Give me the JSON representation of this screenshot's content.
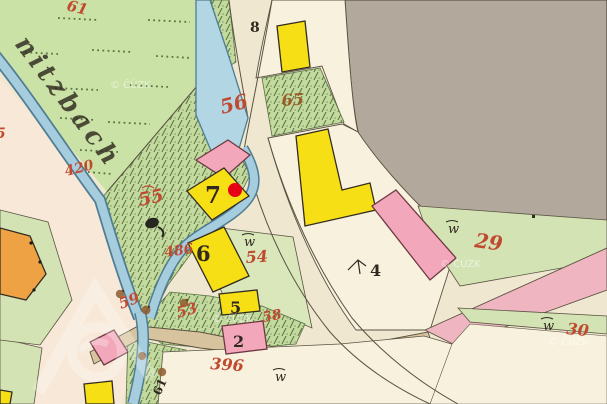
{
  "map": {
    "description": "Historical cadastral map sheet with stream, gardens, roads and numbered buildings",
    "stream_name": "nitzbach",
    "copyright_watermark": "© ČÚZK",
    "symbols": {
      "meadow": "w"
    },
    "marker": {
      "type": "red-dot",
      "on_parcel": "7"
    },
    "labels": {
      "red": {
        "pond_56": "56",
        "garden_65": "65",
        "garden_55": "55",
        "stream_420": "420",
        "stream_486": "486",
        "field_54": "54",
        "garden_53": "53",
        "garden_59": "59",
        "garden_58": "58",
        "field_29": "29",
        "field_30": "30",
        "road_396": "396",
        "edge_partial_5": "5",
        "top_partial_61": "61"
      },
      "black": {
        "road_8": "8",
        "house_7": "7",
        "house_6": "6",
        "house_5": "5",
        "house_2": "2",
        "field_4": "4",
        "stream_61": "61"
      }
    },
    "colors": {
      "paper": "#f0e7d0",
      "paper2": "#f7f1de",
      "pinkpaper": "#f7e8d8",
      "meadow": "#cbe2a6",
      "gardenbase": "#c3d99e",
      "hatch": "#5e7e48",
      "f54": "#d9e7bb",
      "gray": "#b2a89b",
      "graydk": "#4a453c",
      "waterfill": "#a6cddd",
      "wateredge": "#4f7d94",
      "pondfill": "#b2d6e3",
      "tan": "#d7c49e",
      "pinkroad": "#efb6c2",
      "green29": "#d3e3b4",
      "yellow": "#f6df14",
      "pinkbld": "#f2a7ba",
      "orange": "#efa243",
      "ink": "#30291f",
      "red": "#c04a30",
      "brown65": "#9a5c28",
      "tree": "#8f5c2e",
      "line": "#5b5342",
      "dash": "#57743e"
    }
  }
}
